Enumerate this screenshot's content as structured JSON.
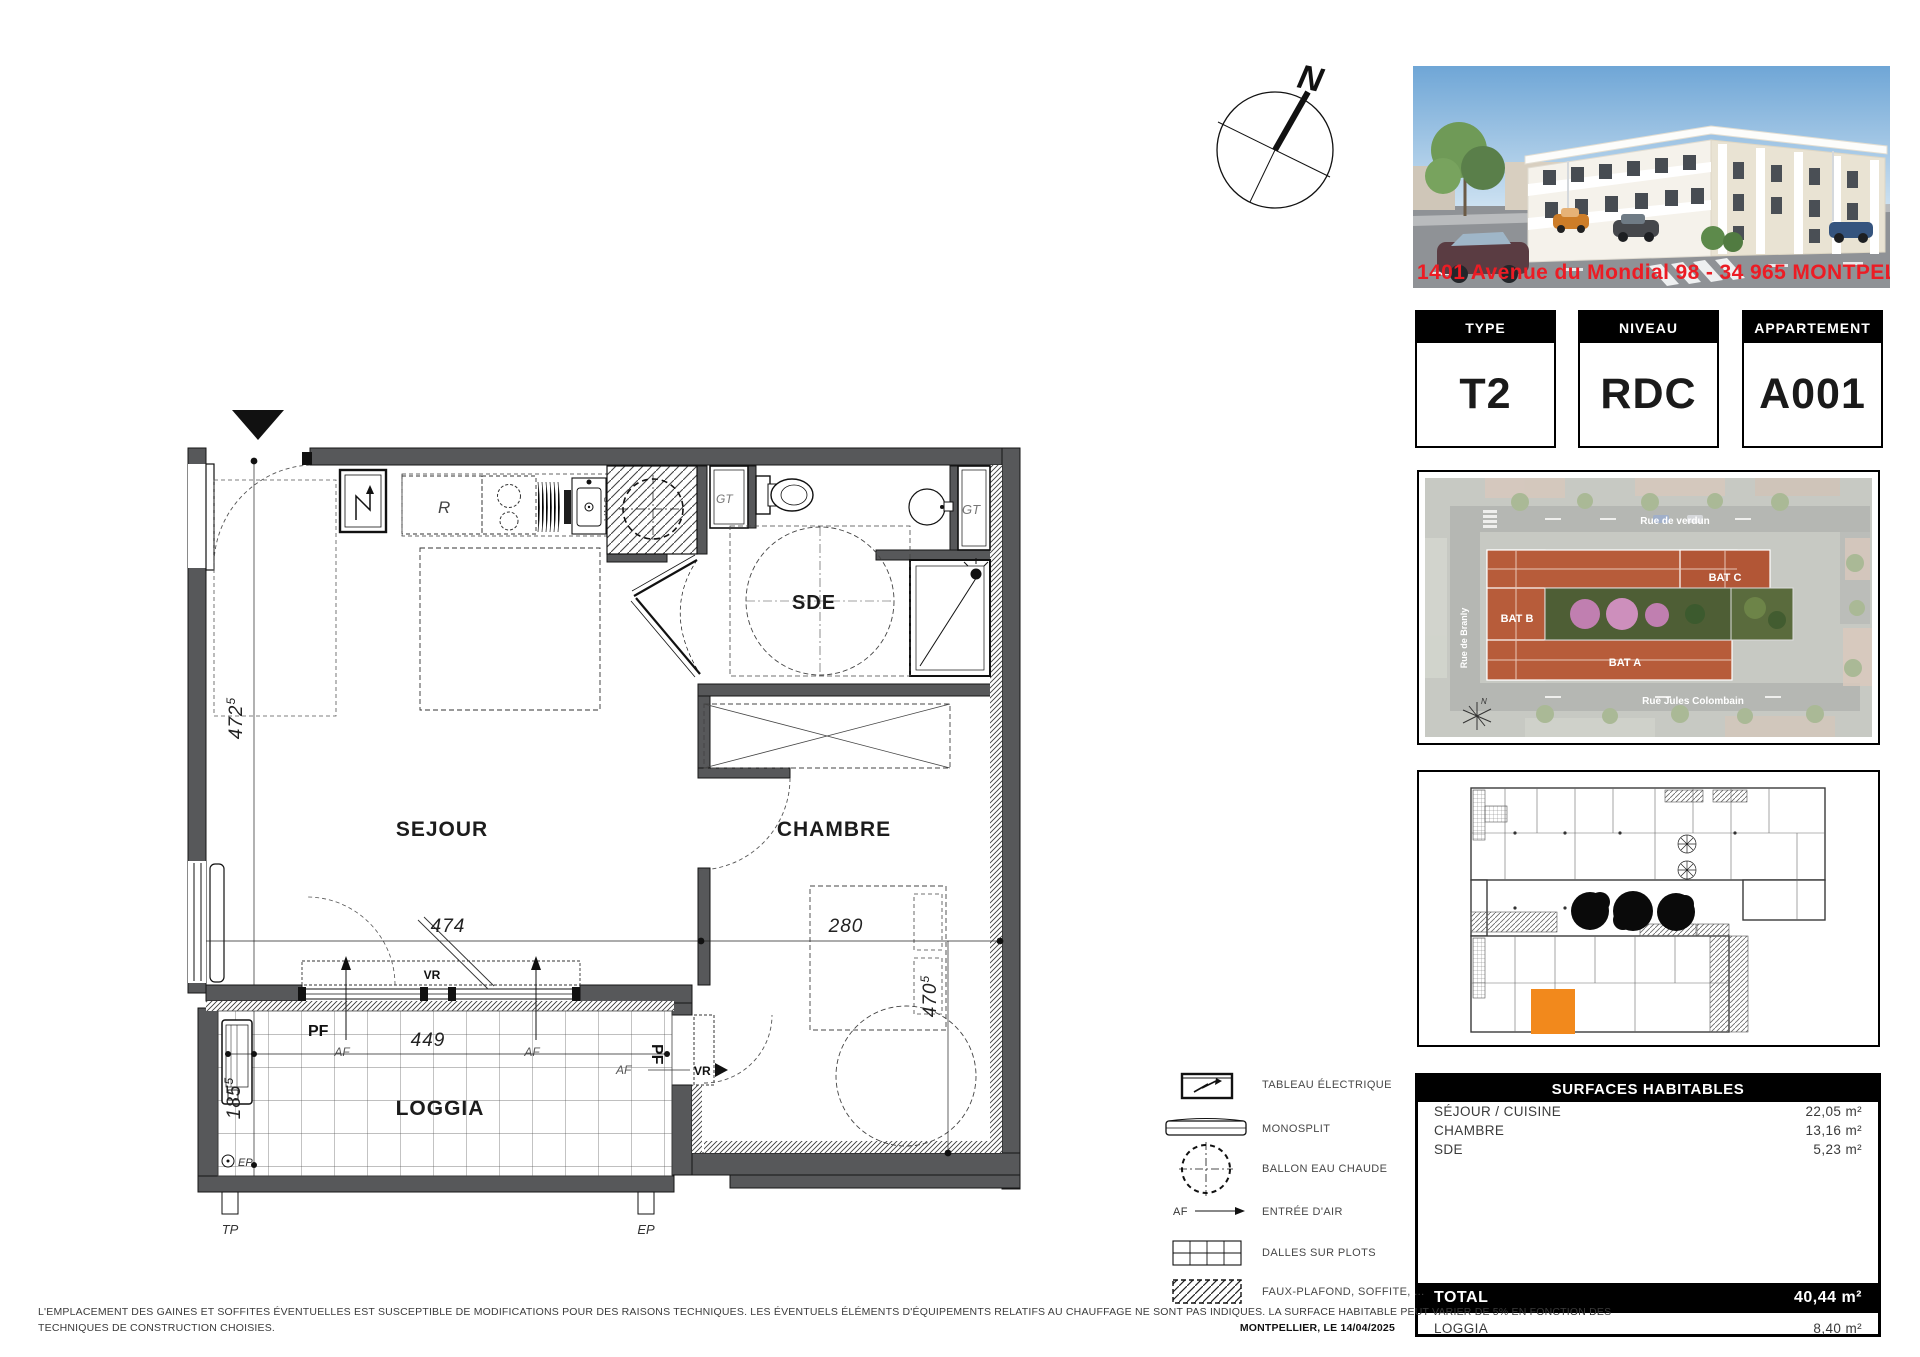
{
  "compass": {
    "label": "N"
  },
  "photo": {
    "address": "1401 Avenue du Mondial 98 - 34 965  MONTPELLIER",
    "address_color": "#ec1c24"
  },
  "info_boxes": [
    {
      "header": "TYPE",
      "value": "T2"
    },
    {
      "header": "NIVEAU",
      "value": "RDC"
    },
    {
      "header": "APPARTEMENT",
      "value": "A001"
    }
  ],
  "site_plan": {
    "street_top": "Rue de verdun",
    "street_bottom": "Rue Jules Colombain",
    "street_left": "Rue de Branly",
    "bat_a": "BAT A",
    "bat_b": "BAT B",
    "bat_c": "BAT C",
    "north": "N",
    "roof_color": "#b75c3a"
  },
  "key_plan": {
    "highlight_color": "#f2891c"
  },
  "surfaces": {
    "title": "SURFACES HABITABLES",
    "rows": [
      {
        "label": "SÉJOUR / CUISINE",
        "value": "22,05 m²"
      },
      {
        "label": "CHAMBRE",
        "value": "13,16 m²"
      },
      {
        "label": "SDE",
        "value": "5,23 m²"
      }
    ],
    "total_label": "TOTAL",
    "total_value": "40,44 m²",
    "loggia_label": "LOGGIA",
    "loggia_value": "8,40 m²"
  },
  "legend": {
    "items": [
      {
        "label": "TABLEAU ÉLECTRIQUE"
      },
      {
        "label": "MONOSPLIT"
      },
      {
        "label": "BALLON EAU CHAUDE"
      },
      {
        "label": "ENTRÉE D'AIR",
        "prefix": "AF"
      },
      {
        "label": "DALLES SUR PLOTS"
      },
      {
        "label": "FAUX-PLAFOND, SOFFITE, ..."
      }
    ]
  },
  "floor_plan": {
    "rooms": {
      "sejour": "SEJOUR",
      "chambre": "CHAMBRE",
      "sde": "SDE",
      "loggia": "LOGGIA"
    },
    "dims": {
      "left": "472",
      "left_sup": "5",
      "sejour_w": "474",
      "chambre_w": "280",
      "chambre_h": "470",
      "chambre_h_sup": "5",
      "loggia_w": "449",
      "loggia_h": "185",
      "loggia_h_sup": "5"
    },
    "labels": {
      "vr": "VR",
      "pf": "PF",
      "af": "AF",
      "gt": "GT",
      "fridge": "R",
      "vmc": "VMC",
      "ep": "EP",
      "tp": "TP"
    }
  },
  "footer": {
    "disclaimer_line1": "L'EMPLACEMENT DES GAINES ET SOFFITES ÉVENTUELLES EST SUSCEPTIBLE DE MODIFICATIONS POUR DES RAISONS TECHNIQUES. LES ÉVENTUELS ÉLÉMENTS D'ÉQUIPEMENTS RELATIFS AU CHAUFFAGE NE SONT PAS INDIQUES. LA SURFACE HABITABLE PEUT VARIER DE 5% EN FONCTION DES",
    "disclaimer_line2": "TECHNIQUES DE CONSTRUCTION CHOISIES.",
    "date": "MONTPELLIER, LE 14/04/2025"
  }
}
